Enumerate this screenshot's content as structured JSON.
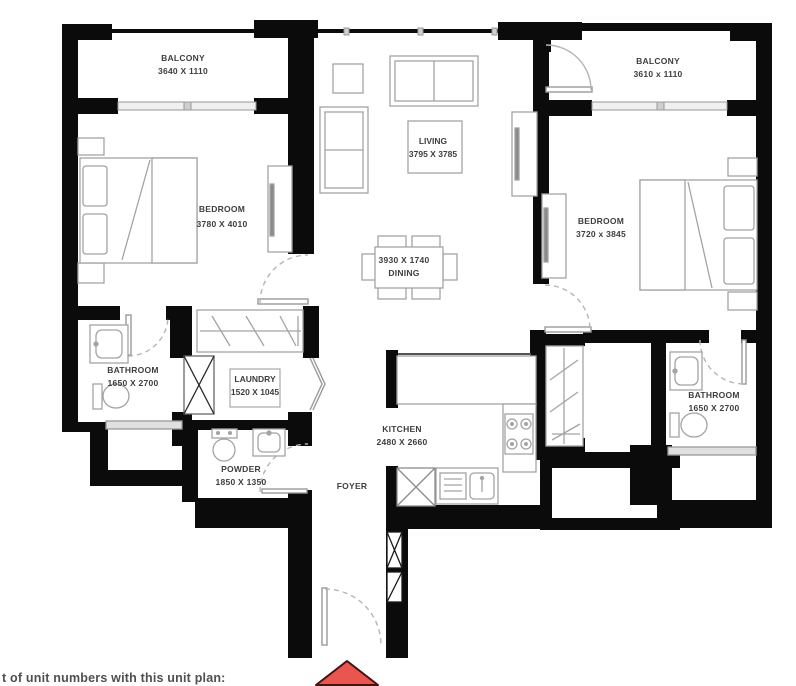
{
  "rooms": {
    "balcony_left": {
      "label": "BALCONY",
      "dims": "3640 X 1110"
    },
    "balcony_right": {
      "label": "BALCONY",
      "dims": "3610 x 1110"
    },
    "bedroom_left": {
      "label": "BEDROOM",
      "dims": "3780 X 4010"
    },
    "bedroom_right": {
      "label": "BEDROOM",
      "dims": "3720 x 3845"
    },
    "living": {
      "label": "LIVING",
      "dims": "3795 X 3785"
    },
    "dining": {
      "label": "DINING",
      "dims": "3930 X 1740"
    },
    "bathroom_left": {
      "label": "BATHROOM",
      "dims": "1650 X 2700"
    },
    "laundry": {
      "label": "LAUNDRY",
      "dims": "1520 X 1045"
    },
    "powder": {
      "label": "POWDER",
      "dims": "1850 X 1350"
    },
    "kitchen": {
      "label": "KITCHEN",
      "dims": "2480 X 2660"
    },
    "foyer": {
      "label": "FOYER"
    },
    "bathroom_right": {
      "label": "BATHROOM",
      "dims": "1650 X 2700"
    }
  },
  "footer": {
    "note": "t of unit numbers with this unit plan:"
  },
  "colors": {
    "entry_arrow": "#ea5550",
    "wall": "#0b0b0b",
    "furniture_line": "#a3a3a3",
    "label_text": "#3e3e3e"
  }
}
